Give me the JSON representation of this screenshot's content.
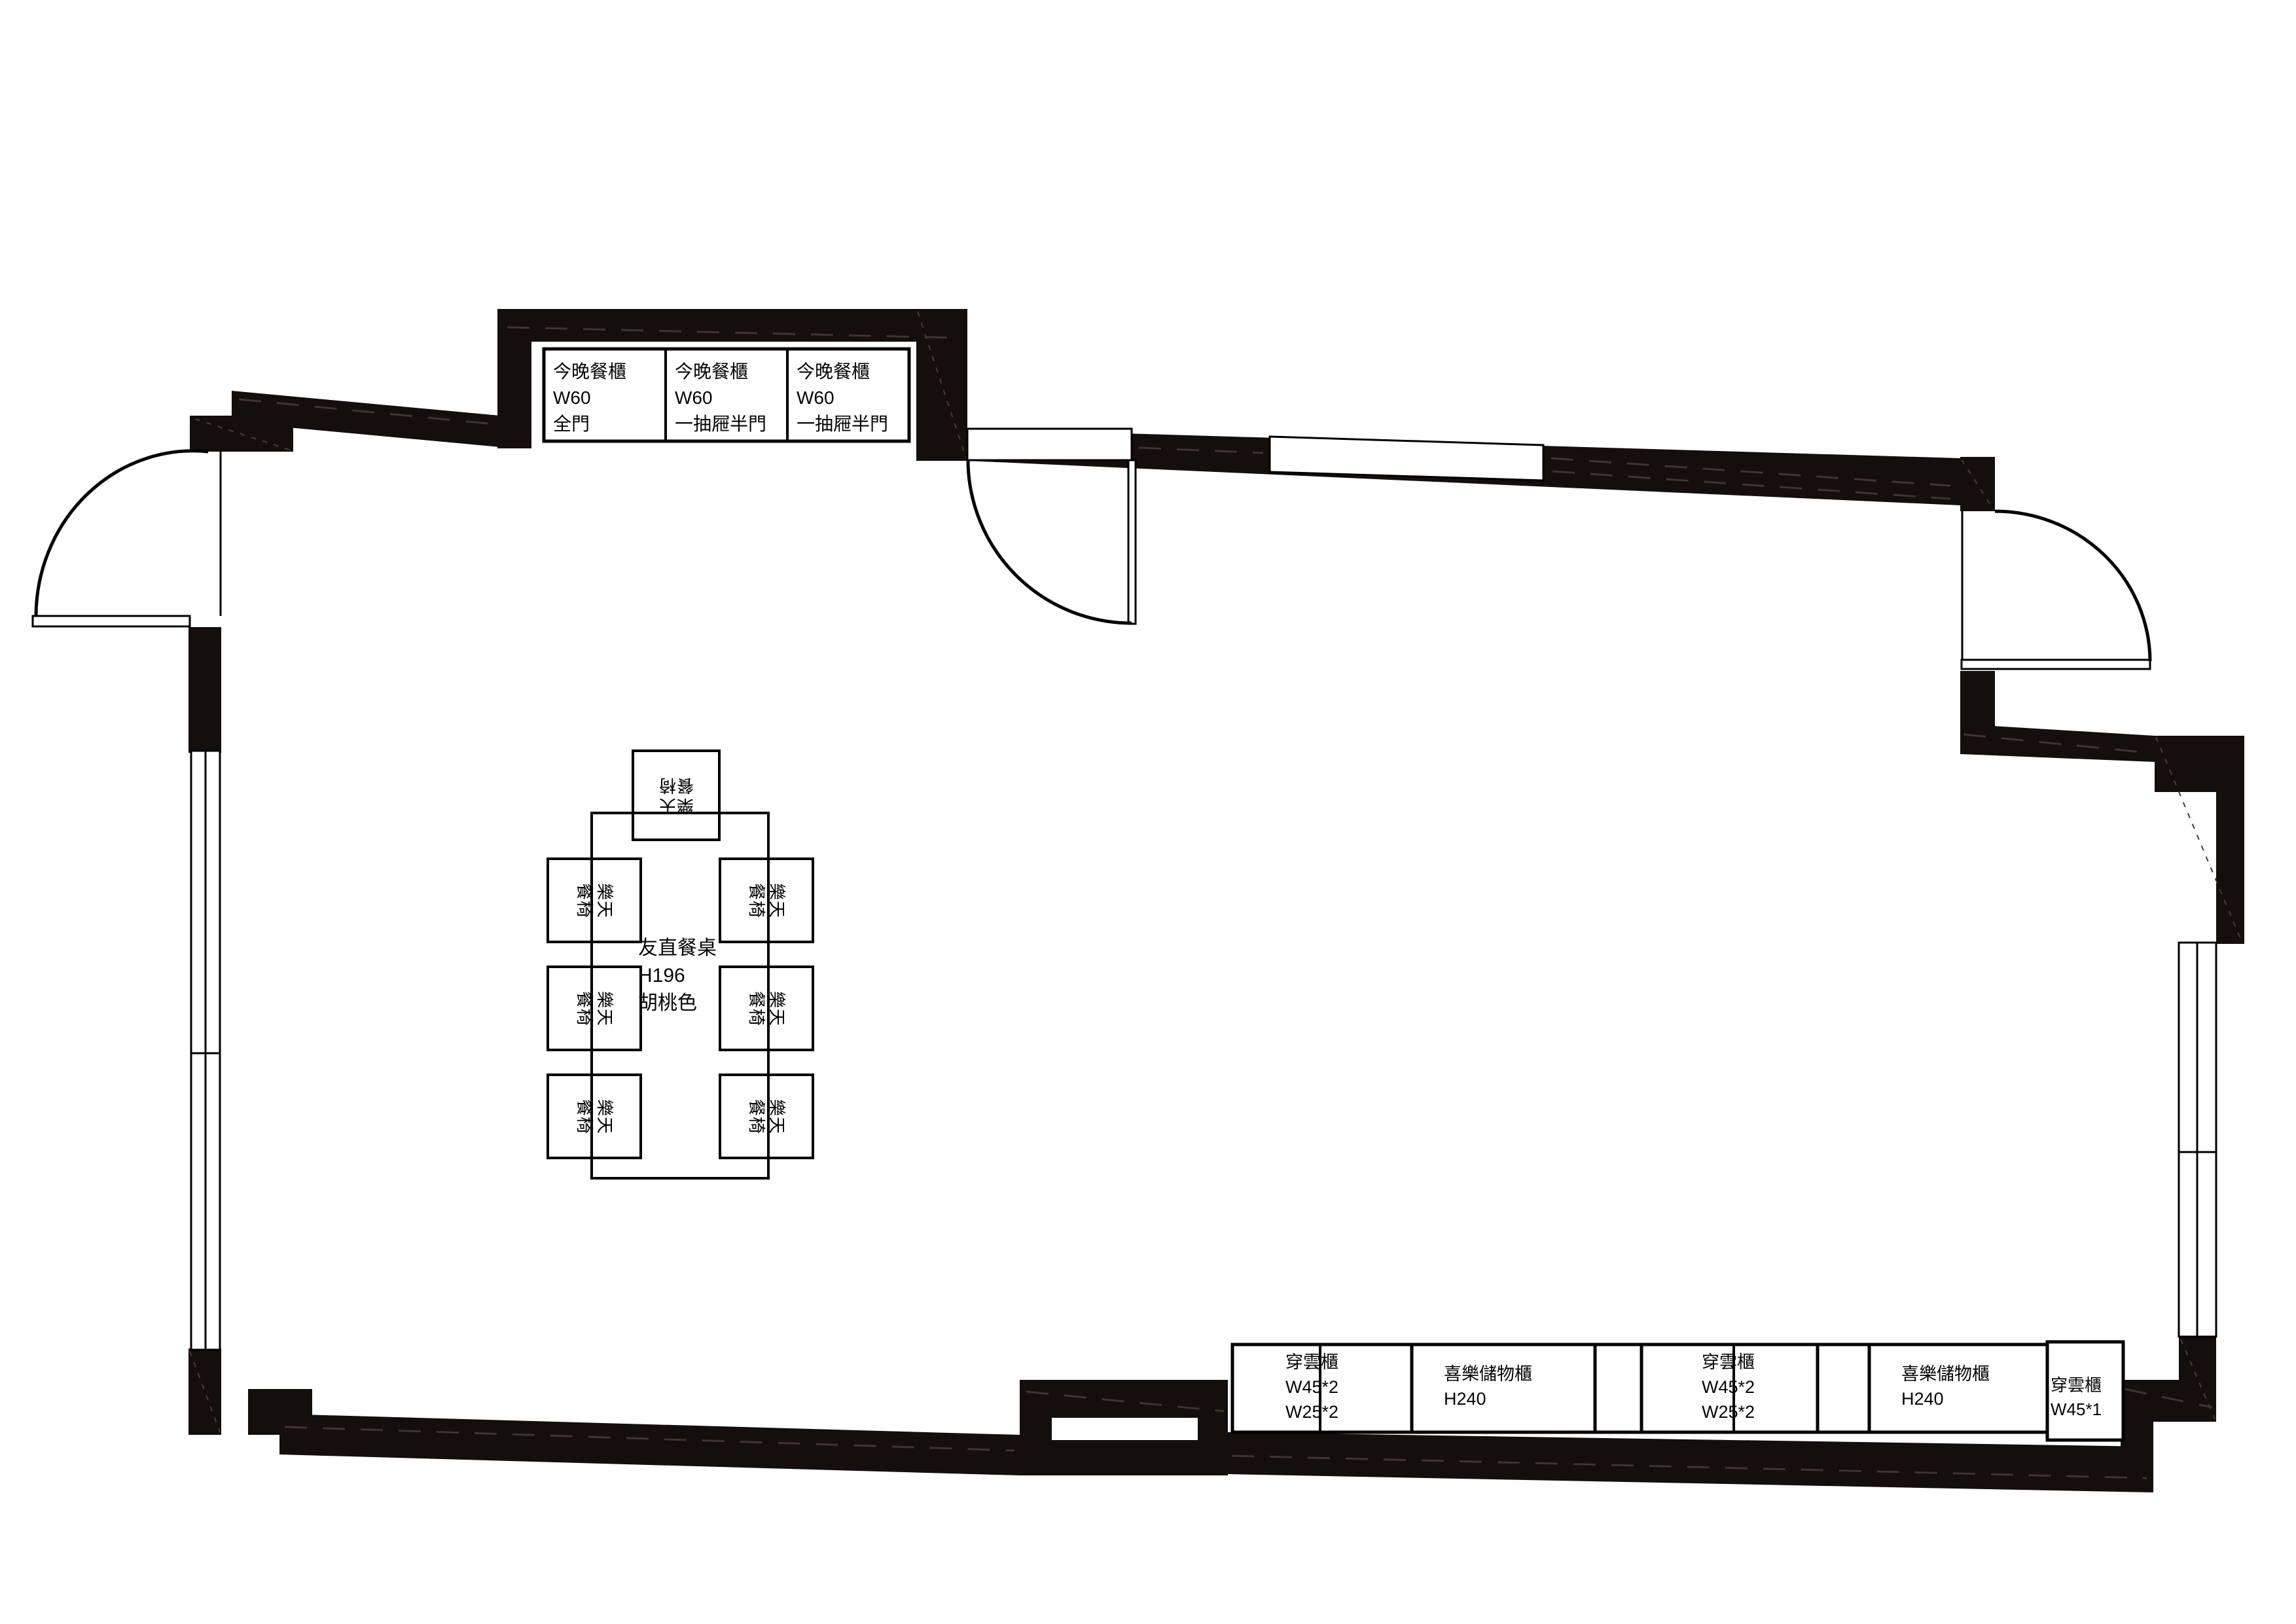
{
  "drawing": {
    "type": "floor-plan",
    "background": "#ffffff",
    "wall_color": "#140e0c",
    "line_color": "#000000"
  },
  "cabinets_top": {
    "items": [
      {
        "lines": [
          "今晚餐櫃",
          "W60",
          "全門"
        ]
      },
      {
        "lines": [
          "今晚餐櫃",
          "W60",
          "一抽屜半門"
        ]
      },
      {
        "lines": [
          "今晚餐櫃",
          "W60",
          "一抽屜半門"
        ]
      }
    ]
  },
  "cabinets_bottom": {
    "items": [
      {
        "lines": [
          "穿雲櫃",
          "W45*2",
          "W25*2"
        ]
      },
      {
        "lines": [
          "喜樂儲物櫃",
          "H240"
        ]
      },
      {
        "lines": [
          "穿雲櫃",
          "W45*2",
          "W25*2"
        ]
      },
      {
        "lines": [
          "喜樂儲物櫃",
          "H240"
        ]
      },
      {
        "lines": [
          "穿雲櫃",
          "W45*1"
        ]
      }
    ]
  },
  "dining_table": {
    "lines": [
      "友直餐桌",
      "H196",
      "胡桃色"
    ]
  },
  "dining_chair": {
    "line1": "樂天",
    "line2": "餐椅"
  }
}
